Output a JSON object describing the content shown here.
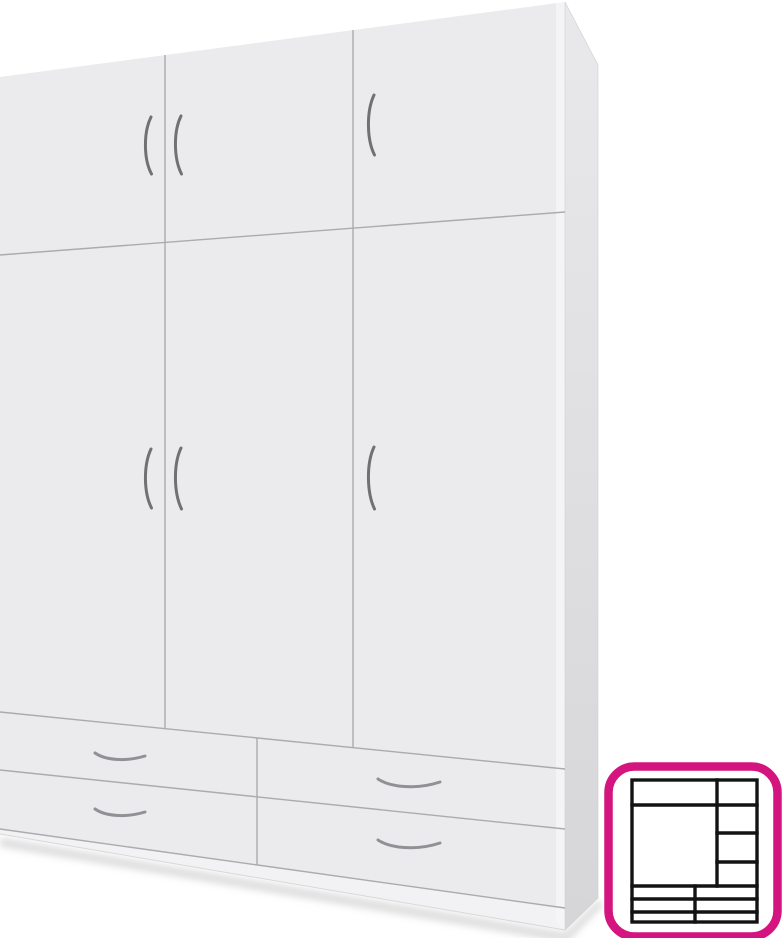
{
  "product_image": {
    "subject": "white-three-door-wardrobe-with-four-drawers",
    "top_cabinet_doors": 3,
    "main_doors": 3,
    "drawers": 4
  },
  "colors": {
    "background": "#ffffff",
    "front_face": "#ebebed",
    "front_highlight": "#f6f6f8",
    "plinth_face": "#f2f2f4",
    "side_top": "#e9e9eb",
    "side_bottom": "#d6d6d8",
    "side_edge": "#cfcfd1",
    "panel_line": "#a9abad",
    "bottom_edge_line": "#d8d8da",
    "door_handle": "#6f7173",
    "drawer_handle": "#8f9194",
    "shadow": "#c6c6c8",
    "badge_border": "#d4157f",
    "badge_bg": "#ffffff",
    "schematic_line": "#131313"
  }
}
